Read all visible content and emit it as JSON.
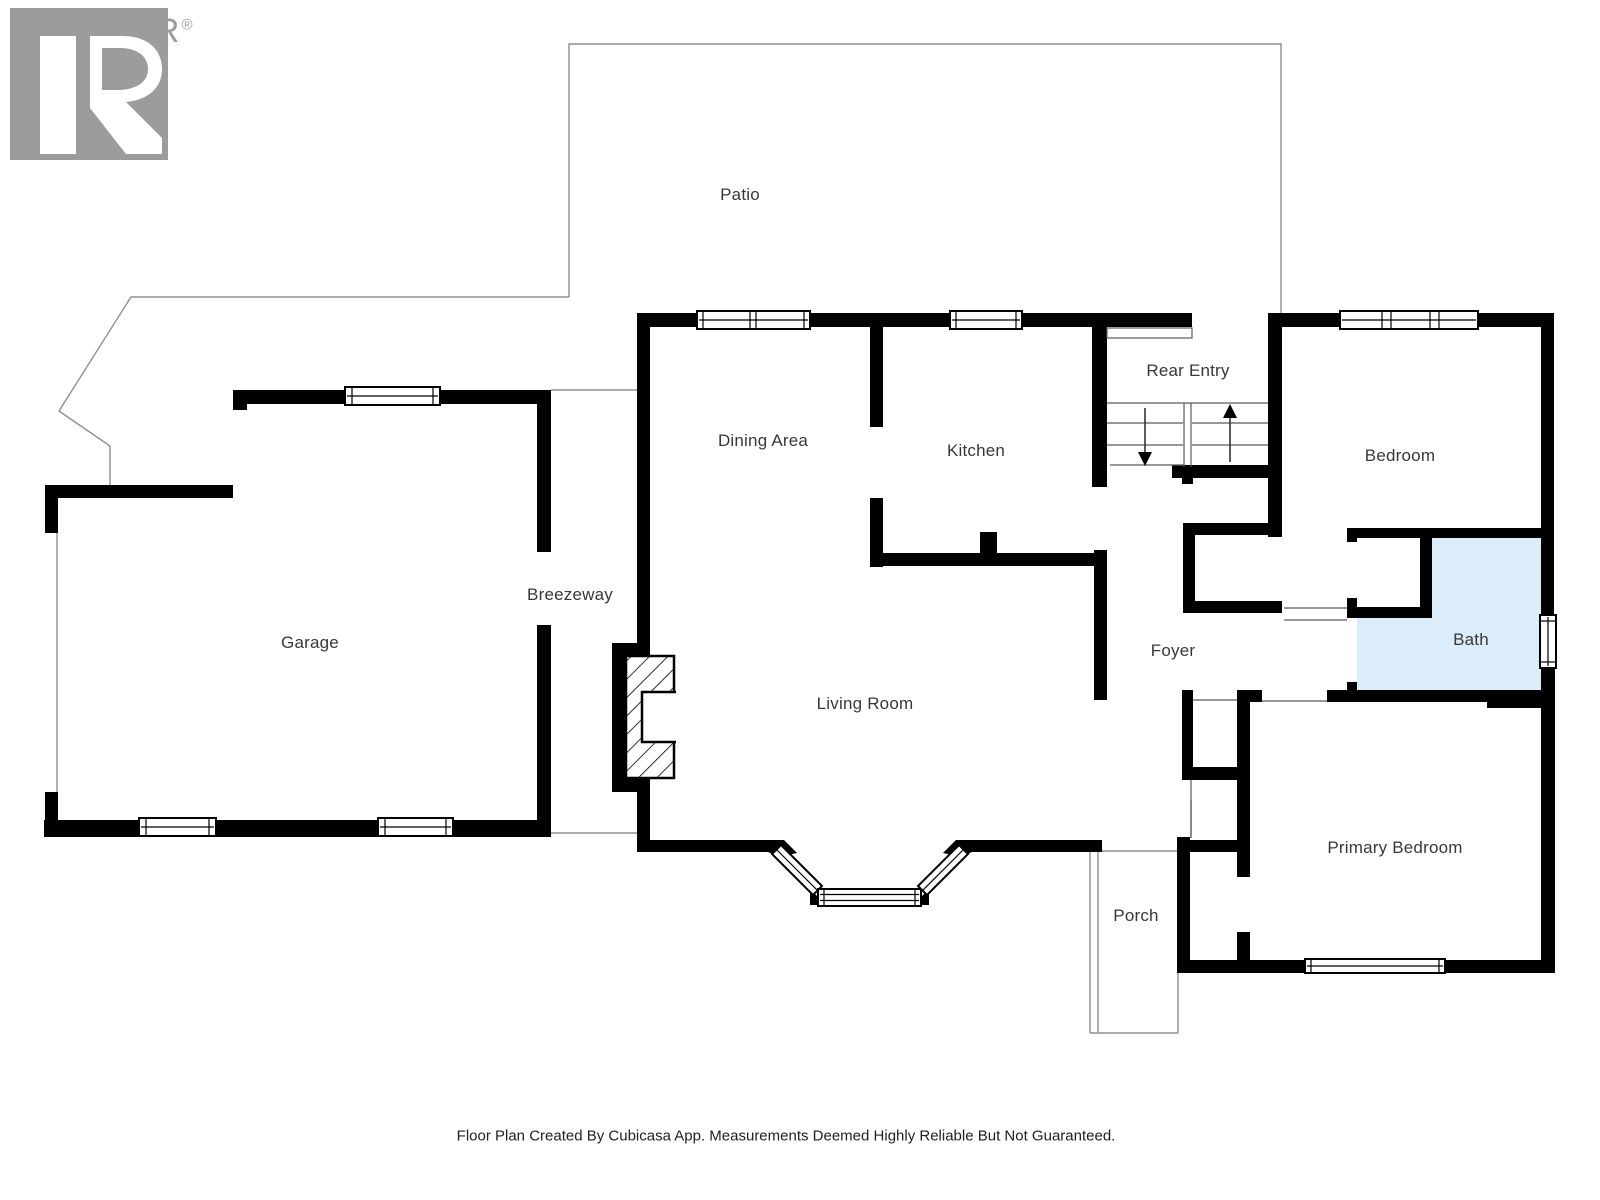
{
  "watermark": {
    "brand": "REALTOR",
    "registered": "®"
  },
  "rooms": {
    "patio": {
      "label": "Patio"
    },
    "garage": {
      "label": "Garage"
    },
    "breezeway": {
      "label": "Breezeway"
    },
    "dining": {
      "label": "Dining Area"
    },
    "kitchen": {
      "label": "Kitchen"
    },
    "rear_entry": {
      "label": "Rear Entry"
    },
    "bedroom": {
      "label": "Bedroom"
    },
    "bath": {
      "label": "Bath"
    },
    "foyer": {
      "label": "Foyer"
    },
    "living": {
      "label": "Living Room"
    },
    "porch": {
      "label": "Porch"
    },
    "primary": {
      "label": "Primary Bedroom"
    }
  },
  "icons": {
    "stairs_up_arrow": "up-arrow",
    "stairs_down_arrow": "down-arrow"
  },
  "footer": {
    "text": "Floor Plan Created By Cubicasa App. Measurements Deemed Highly Reliable But Not Guaranteed."
  },
  "colors": {
    "wall": "#000000",
    "bath_fill": "#dcecf8",
    "thin_line": "#8f8f8f",
    "stair_line": "#5a5a5a",
    "label_text": "#383838",
    "watermark_gray": "#9c9c9c"
  }
}
